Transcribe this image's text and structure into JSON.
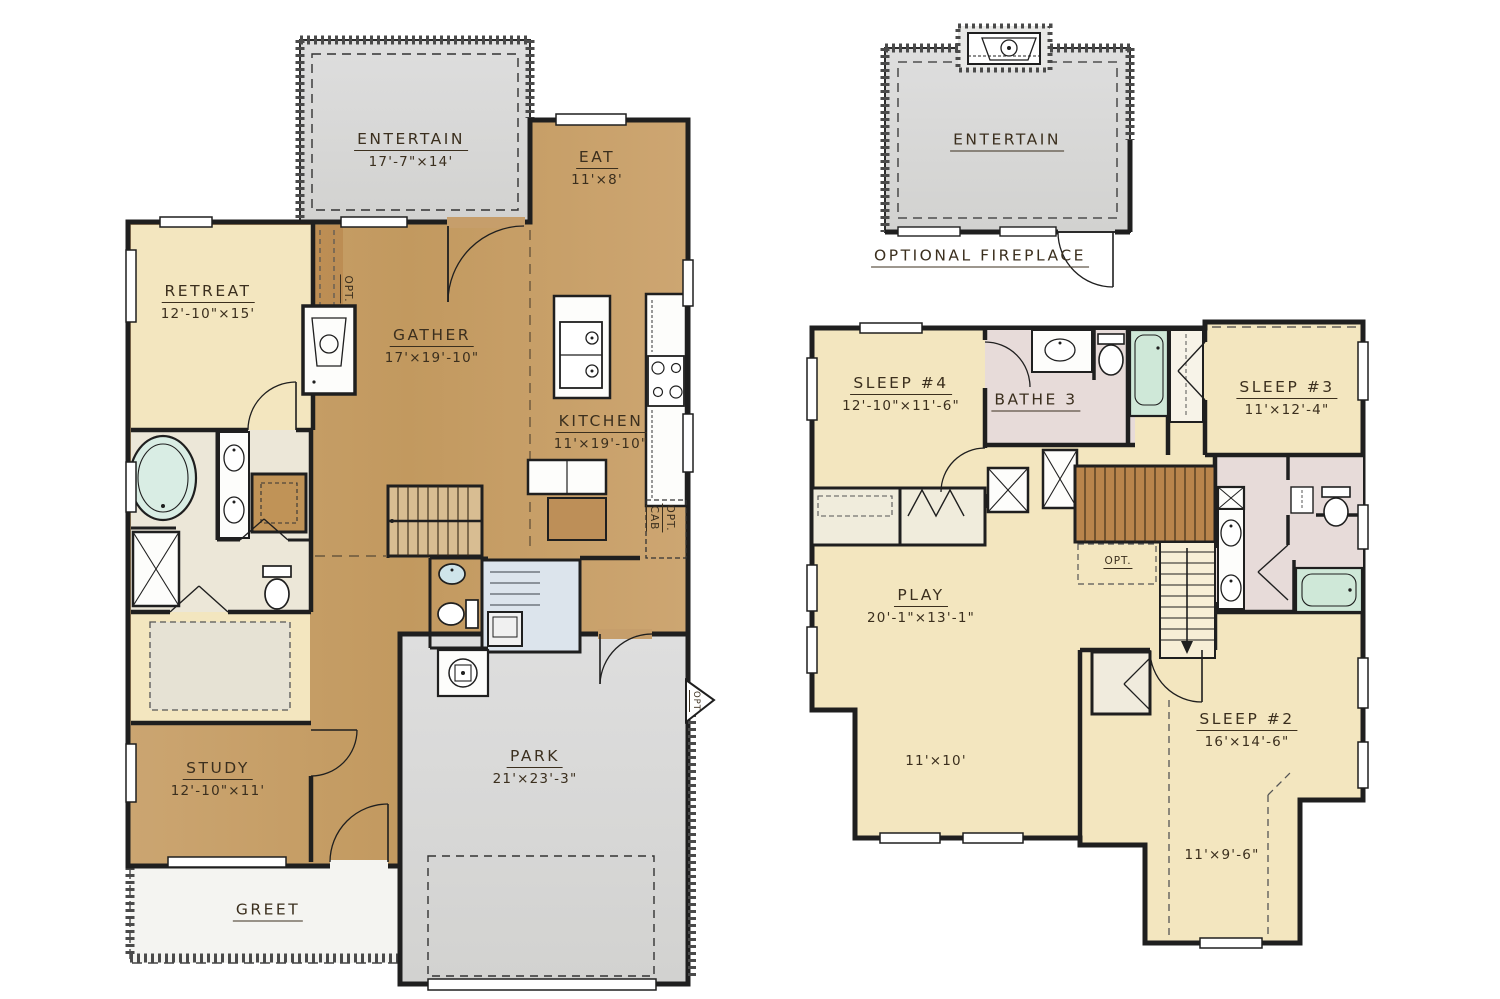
{
  "colors": {
    "wood": "#c69e6b",
    "wood_dark": "#b9854c",
    "cream": "#f3e6bf",
    "bath_floor": "#ece7d8",
    "gray": "#d9d9d6",
    "bath_pink": "#e7dbd9",
    "tub_green": "#cfe8d8",
    "laundry_blue": "#dce4ec",
    "wall": "#1f1f1f"
  },
  "first_floor": {
    "rooms": {
      "entertain": {
        "name": "ENTERTAIN",
        "dims": "17'-7\"×14'"
      },
      "eat": {
        "name": "EAT",
        "dims": "11'×8'"
      },
      "retreat": {
        "name": "RETREAT",
        "dims": "12'-10\"×15'"
      },
      "gather": {
        "name": "GATHER",
        "dims": "17'×19'-10\""
      },
      "kitchen": {
        "name": "KITCHEN",
        "dims": "11'×19'-10\""
      },
      "study": {
        "name": "STUDY",
        "dims": "12'-10\"×11'"
      },
      "park": {
        "name": "PARK",
        "dims": "21'×23'-3\""
      },
      "greet": {
        "name": "GREET"
      }
    },
    "notes": {
      "opt_media": "OPT.",
      "opt_cab_1": "OPT.",
      "opt_cab_2": "CAB",
      "opt_door": "OPT"
    }
  },
  "second_floor": {
    "rooms": {
      "entertain": {
        "name": "ENTERTAIN"
      },
      "sleep4": {
        "name": "SLEEP #4",
        "dims": "12'-10\"×11'-6\""
      },
      "bathe3": {
        "name": "BATHE 3"
      },
      "sleep3": {
        "name": "SLEEP #3",
        "dims": "11'×12'-4\""
      },
      "play": {
        "name": "PLAY",
        "dims": "20'-1\"×13'-1\""
      },
      "sleep2": {
        "name": "SLEEP #2",
        "dims": "16'×14'-6\""
      }
    },
    "extra_dims": {
      "play_alcove": "11'×10'",
      "sleep2_alcove": "11'×9'-6\""
    },
    "caption": "OPTIONAL FIREPLACE",
    "notes": {
      "opt_stairs": "OPT."
    }
  }
}
